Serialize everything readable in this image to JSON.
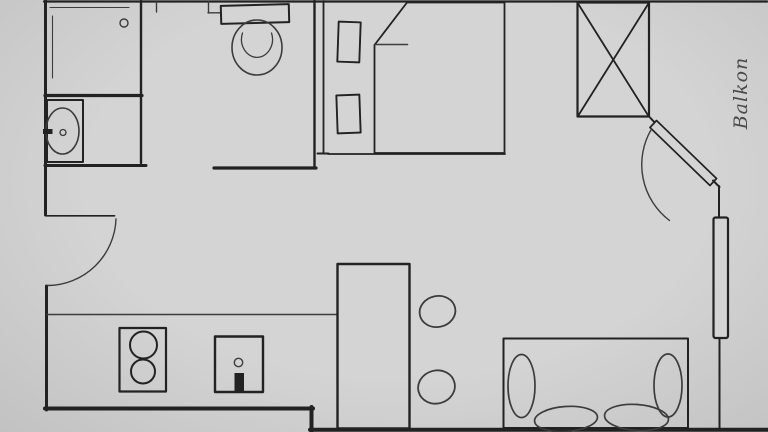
{
  "document": {
    "kind": "hand-drawn apartment floor plan sketch",
    "canvas": {
      "width": 768,
      "height": 432
    }
  },
  "labels": {
    "balcony": "Balkon"
  },
  "colors": {
    "background": "#d4d4d4",
    "background_edge": "#c2c2c2",
    "ink": "#222222",
    "ink_secondary": "#3c3c3c",
    "label_text": "#4a4a4a"
  },
  "fixtures": [
    "walls",
    "shower",
    "bathroom-sink",
    "toilet",
    "entrance-door",
    "bed",
    "bed-pillows",
    "wardrobe",
    "balcony-door",
    "balcony-window",
    "sofa",
    "kitchen-counter",
    "stove",
    "kitchen-sink",
    "kitchen-island",
    "bar-stools"
  ]
}
